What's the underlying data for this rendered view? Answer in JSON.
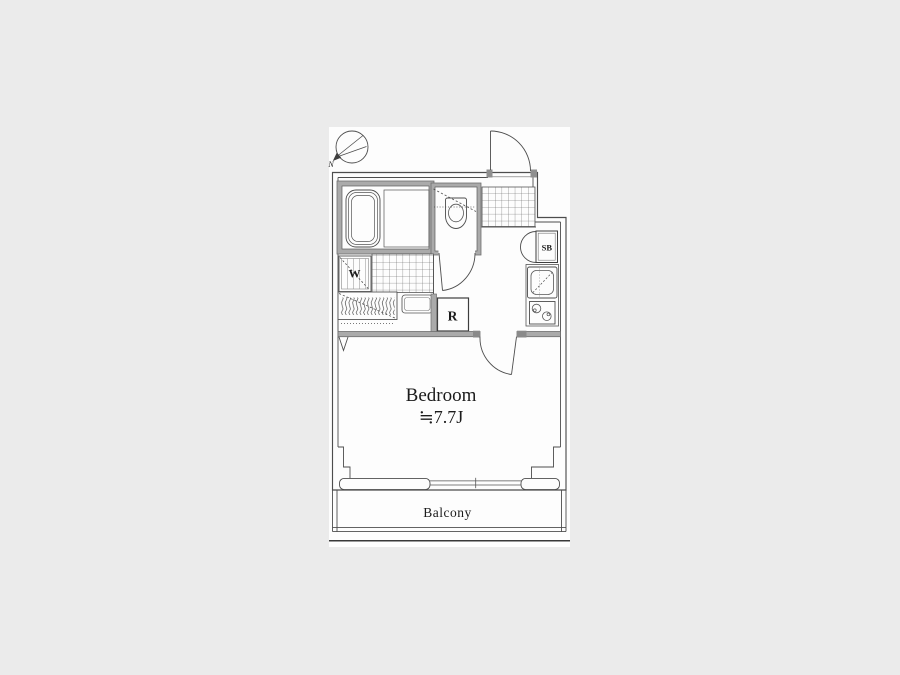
{
  "colors": {
    "background": "#ebebeb",
    "paper": "#fdfdfd",
    "line": "#4d4d4d",
    "wall_fill": "#aaaaaa"
  },
  "floor_plan": {
    "bedroom": {
      "name": "Bedroom",
      "size": "≒7.7J"
    },
    "balcony": {
      "name": "Balcony"
    },
    "refrigerator_space": {
      "abbr": "R"
    },
    "washing_machine_space": {
      "abbr": "W"
    },
    "shoe_box": {
      "abbr": "SB"
    },
    "compass": {
      "north": "N"
    }
  }
}
